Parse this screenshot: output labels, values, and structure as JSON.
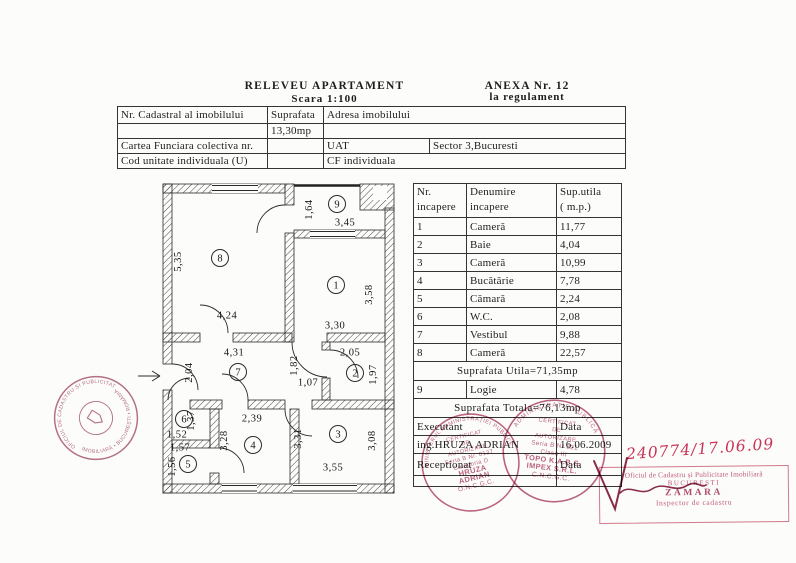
{
  "header": {
    "title": "RELEVEU APARTAMENT",
    "scale": "Scara 1:100",
    "anexa_line1": "ANEXA Nr. 12",
    "anexa_line2": "la regulament"
  },
  "info_table": {
    "cadastral_label": "Nr. Cadastral al imobilului",
    "suprafata_label": "Suprafata",
    "adresa_label": "Adresa imobilului",
    "suprafata_value": "13,30mp",
    "cartea_label": "Cartea Funciara colectiva nr.",
    "uat_label": "UAT",
    "sector_value": "Sector 3,Bucuresti",
    "cod_label": "Cod unitate individuala (U)",
    "cf_value": "CF individuala"
  },
  "rooms_table": {
    "header": {
      "col1_l1": "Nr.",
      "col1_l2": "incapere",
      "col2_l1": "Denumire",
      "col2_l2": "incapere",
      "col3_l1": "Sup.utila",
      "col3_l2": "( m.p.)"
    },
    "rows": [
      {
        "nr": "1",
        "name": "Cameră",
        "area": "11,77"
      },
      {
        "nr": "2",
        "name": "Baie",
        "area": "4,04"
      },
      {
        "nr": "3",
        "name": "Cameră",
        "area": "10,99"
      },
      {
        "nr": "4",
        "name": "Bucătărie",
        "area": "7,78"
      },
      {
        "nr": "5",
        "name": "Cămară",
        "area": "2,24"
      },
      {
        "nr": "6",
        "name": "W.C.",
        "area": "2,08"
      },
      {
        "nr": "7",
        "name": "Vestibul",
        "area": "9,88"
      },
      {
        "nr": "8",
        "name": "Cameră",
        "area": "22,57"
      }
    ],
    "subtotal": "Suprafata Utila=71,35mp",
    "row9": {
      "nr": "9",
      "name": "Logie",
      "area": "4,78"
    },
    "total": "Suprafata Totala=76,13mp",
    "executant_label": "Executant",
    "data_label_1": "Data",
    "executant_name": "ing.HRUZA ADRIAN",
    "executant_date": "16.06.2009",
    "receptionat_label": "Receptionat",
    "data_label_2": "Data"
  },
  "floorplan": {
    "room_numbers": [
      {
        "id": "r8",
        "text": "8"
      },
      {
        "id": "r9",
        "text": "9"
      },
      {
        "id": "r1",
        "text": "1"
      },
      {
        "id": "r2",
        "text": "2"
      },
      {
        "id": "r7",
        "text": "7"
      },
      {
        "id": "r6",
        "text": "6"
      },
      {
        "id": "r5",
        "text": "5"
      },
      {
        "id": "r4",
        "text": "4"
      },
      {
        "id": "r3",
        "text": "3"
      }
    ],
    "dimensions": [
      {
        "id": "d1",
        "text": "5,35"
      },
      {
        "id": "d2",
        "text": "4,24"
      },
      {
        "id": "d3",
        "text": "1,64"
      },
      {
        "id": "d4",
        "text": "3,45"
      },
      {
        "id": "d5",
        "text": "3,58"
      },
      {
        "id": "d6",
        "text": "3,30"
      },
      {
        "id": "d7",
        "text": "2,05"
      },
      {
        "id": "d8",
        "text": "1,97"
      },
      {
        "id": "d9",
        "text": "4,31"
      },
      {
        "id": "d10",
        "text": "2,04"
      },
      {
        "id": "d11",
        "text": "1,82"
      },
      {
        "id": "d12",
        "text": "1,07"
      },
      {
        "id": "d13",
        "text": "1,37"
      },
      {
        "id": "d14",
        "text": "1,52"
      },
      {
        "id": "d15",
        "text": "1,57"
      },
      {
        "id": "d16",
        "text": "1,56"
      },
      {
        "id": "d17",
        "text": "2,39"
      },
      {
        "id": "d18",
        "text": "3,28"
      },
      {
        "id": "d19",
        "text": "3,31"
      },
      {
        "id": "d20",
        "text": "3,08"
      },
      {
        "id": "d21",
        "text": "3,55"
      }
    ]
  },
  "stamps": {
    "ink_color": "#b2496b",
    "oficiu_round": {
      "ring_top": "OFICIUL DE CADASTRU ȘI PUBLICITATE",
      "ring_bottom": "IMOBILIARĂ • BUCUREȘTI • ROMÂNIA"
    },
    "executant_round": {
      "ring_top": "MINISTERUL ADMINISTRAȚIEI PUBLICE",
      "lines": [
        "CERTIFICAT",
        "DE",
        "AUTORIZARE",
        "Seria B Nr. 0137",
        "Categoria D",
        "HRUZA",
        "ADRIAN",
        "O.N.C.G.C."
      ]
    },
    "firm_round": {
      "ring_top": "ADMINISTRAȚIE PUBLICĂ",
      "lines": [
        "CERTIFICAT",
        "DE",
        "AUTORIZARE",
        "Seria B Nr 321",
        "Clasa III",
        "TOPO K.A.B.S.",
        "IMPEX S.R.L.",
        "C.N.C.G.C."
      ]
    },
    "rect_stamp": {
      "line1": "Oficiul de Cadastru și Publicitate Imobiliară",
      "line2": "BUCUREȘTI",
      "line3": "ZAMARA",
      "line4": "Inspector de cadastru"
    },
    "handwritten_number": "240774/17.06.09"
  }
}
